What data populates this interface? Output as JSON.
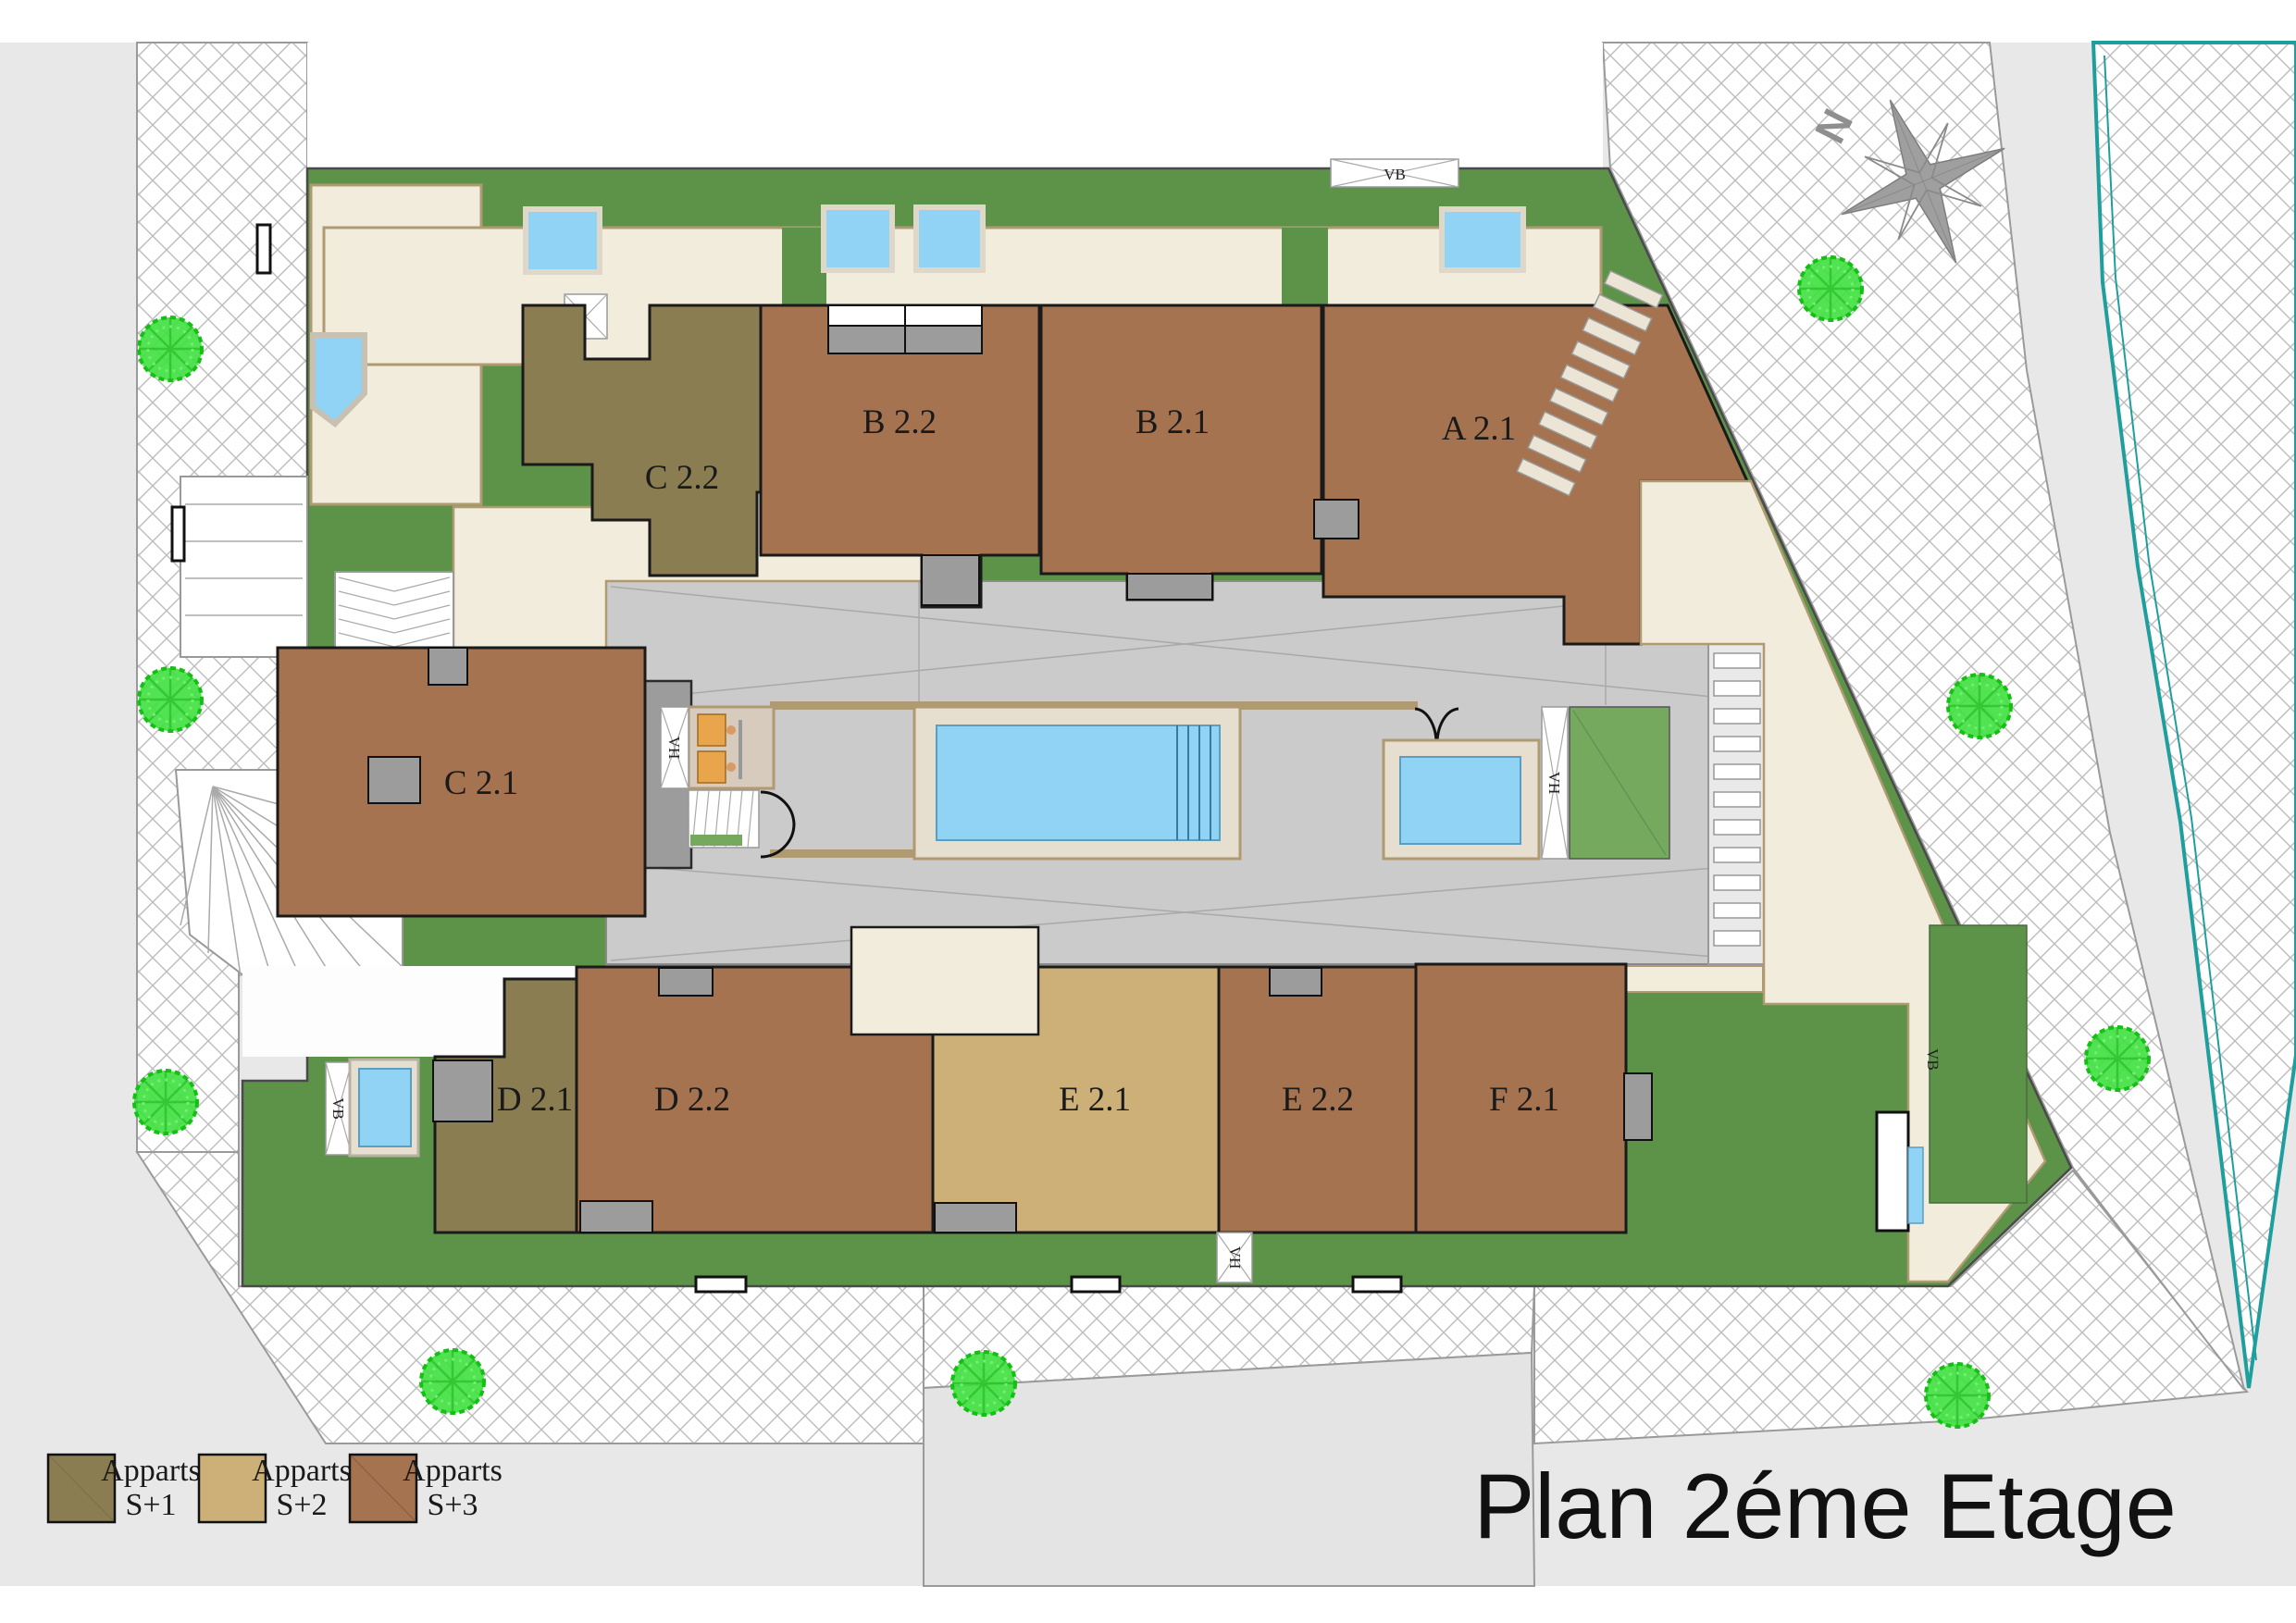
{
  "title": "Plan 2éme Etage",
  "compass": {
    "north_label": "N"
  },
  "legend": {
    "items": [
      {
        "label": "Apparts",
        "sublabel": "S+1",
        "color": "#8a7d52"
      },
      {
        "label": "Apparts",
        "sublabel": "S+2",
        "color": "#cdb077"
      },
      {
        "label": "Apparts",
        "sublabel": "S+3",
        "color": "#a5734f"
      }
    ]
  },
  "apartments": [
    {
      "id": "C 2.2",
      "category": "S+1",
      "color": "#8a7d52"
    },
    {
      "id": "B 2.2",
      "category": "S+3",
      "color": "#a5734f"
    },
    {
      "id": "B 2.1",
      "category": "S+3",
      "color": "#a5734f"
    },
    {
      "id": "A 2.1",
      "category": "S+3",
      "color": "#a5734f"
    },
    {
      "id": "C 2.1",
      "category": "S+3",
      "color": "#a5734f"
    },
    {
      "id": "D 2.1",
      "category": "S+1",
      "color": "#8a7d52"
    },
    {
      "id": "D 2.2",
      "category": "S+3",
      "color": "#a5734f"
    },
    {
      "id": "E 2.1",
      "category": "S+2",
      "color": "#cdb077"
    },
    {
      "id": "E 2.2",
      "category": "S+3",
      "color": "#a5734f"
    },
    {
      "id": "F 2.1",
      "category": "S+3",
      "color": "#a5734f"
    }
  ],
  "shafts": [
    {
      "text": "VB"
    },
    {
      "text": "VB"
    },
    {
      "text": "VB"
    },
    {
      "text": "VH"
    },
    {
      "text": "VH"
    },
    {
      "text": "VH"
    }
  ],
  "colors": {
    "background": "#e8e8e8",
    "grass": "#5c9349",
    "grass_light": "#74a95e",
    "terrace_cream": "#f2ecdc",
    "wall_tan": "#b09a72",
    "courtyard_gray": "#cbcbcb",
    "pool_blue": "#90d3f4",
    "tree_green": "#3fe03f",
    "street_border_teal": "#1f9e9e",
    "apartment_brown": "#a5734f",
    "apartment_olive": "#8a7d52",
    "apartment_tan": "#cdb077"
  }
}
